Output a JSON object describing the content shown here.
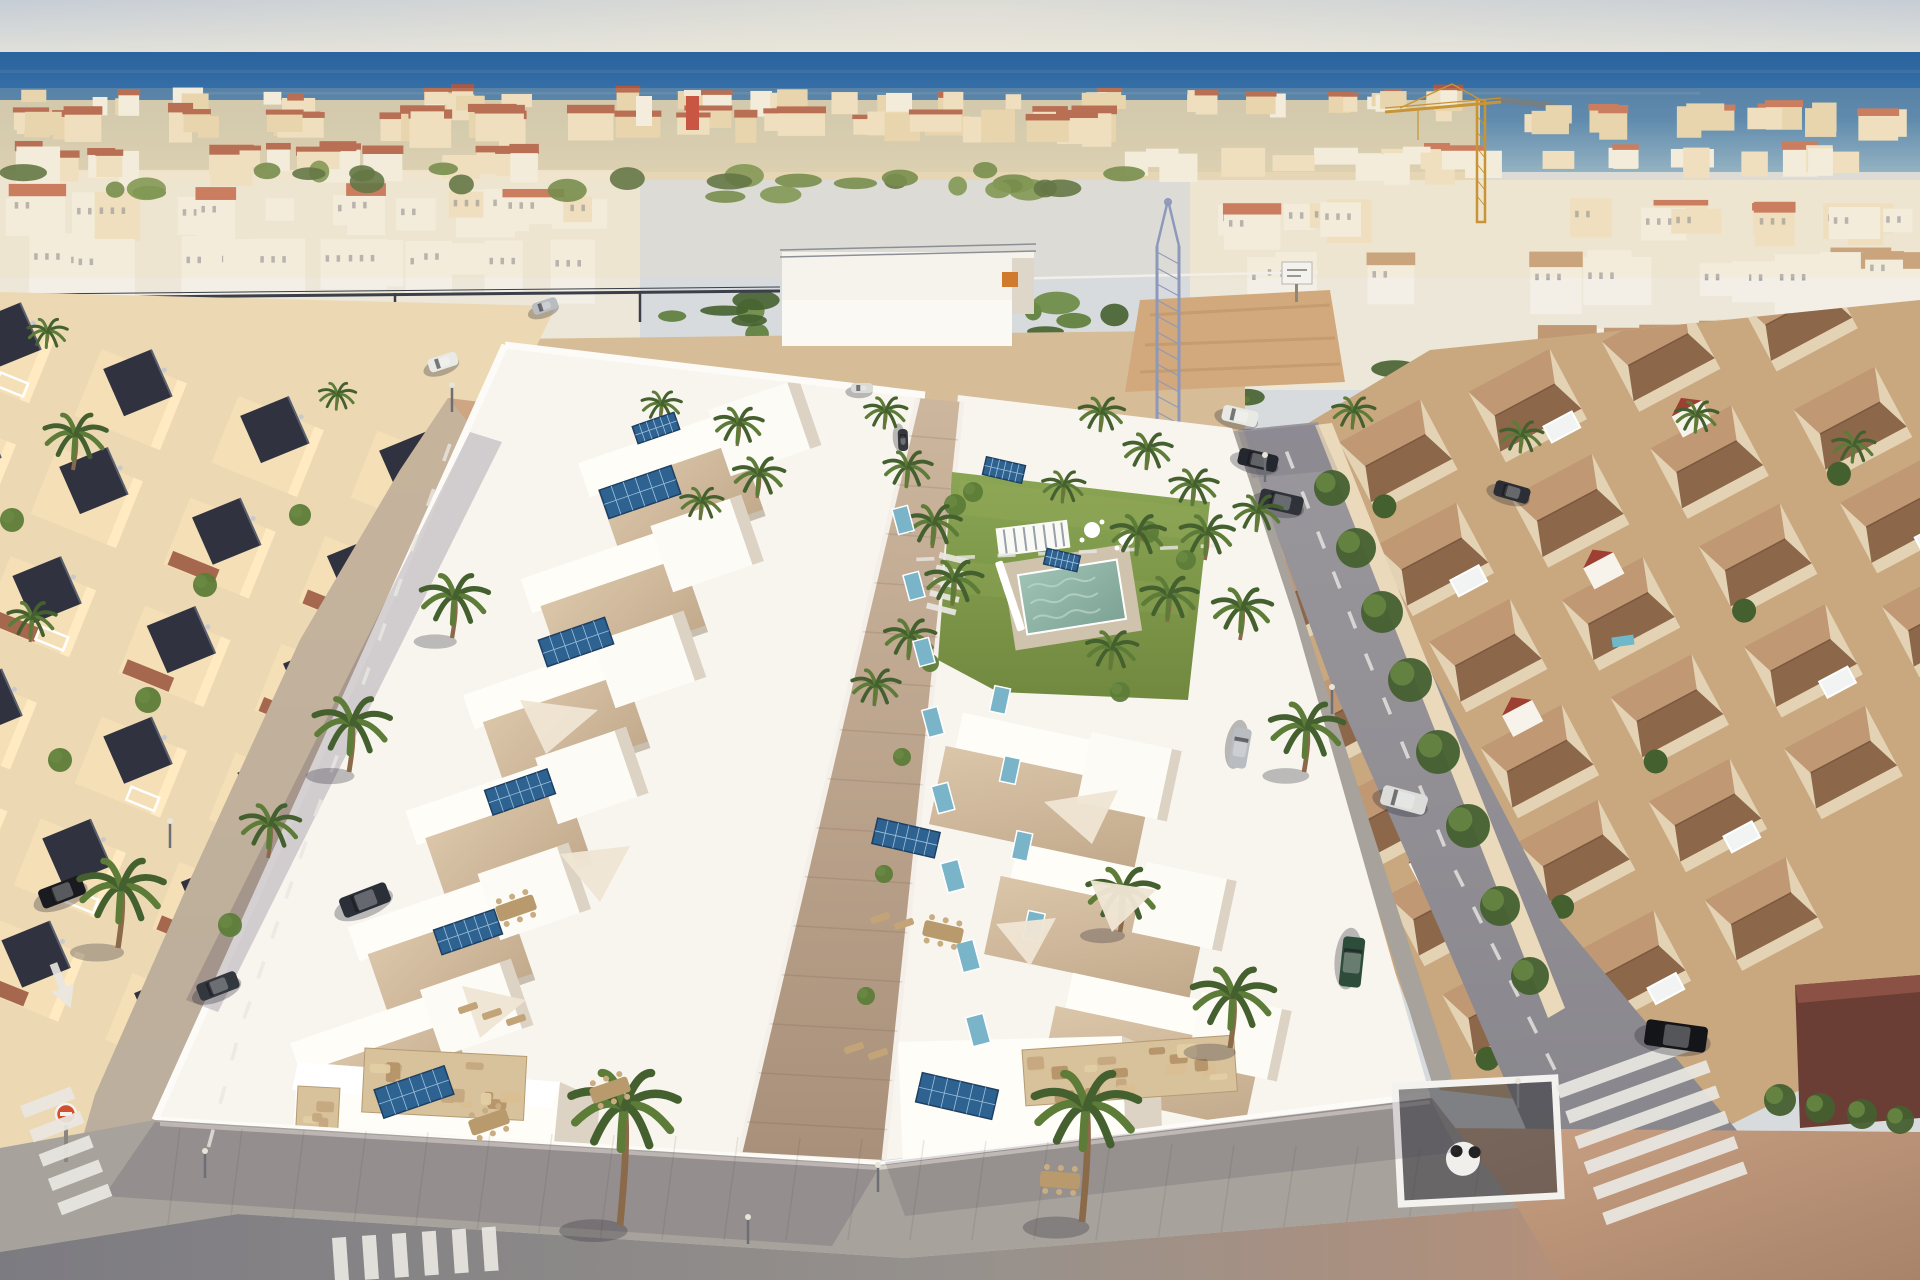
{
  "meta": {
    "description": "Aerial drone render of a new beachfront development of white villas with rooftop solar panels, communal lawn and pool, flanked by an older cream villa neighborhood on the left, terracotta-roofed townhouses on the right, palm-lined streets, zebra crossings, parked cars, construction cranes and the sea on the horizon."
  },
  "palette": {
    "sky_top": "#c6cdd5",
    "sky_low": "#e9e6dc",
    "sea_deep": "#2a639d",
    "sea_mid": "#3f78ae",
    "sea_near": "#7fa9c6",
    "city_white": "#f3efe6",
    "city_cream": "#e6d3ae",
    "city_cream2": "#eee0c2",
    "red_roof": "#ad5741",
    "red_roof2": "#c26a4f",
    "red_tower": "#c0392b",
    "green1": "#45602f",
    "green2": "#5d7c38",
    "green3": "#6a8a43",
    "villa_white": "#f8f5ef",
    "villa_bright": "#fffdf8",
    "villa_shade": "#ddd3c4",
    "terr_hi": "#dbc6a9",
    "terr_lo": "#c2a98c",
    "terr_dark": "#a9917b",
    "solar": "#2e6391",
    "solar_dark": "#1d3f63",
    "solar_teal": "#79b4c9",
    "lawn_hi": "#8aa554",
    "lawn_lo": "#71893f",
    "pool_hi": "#9fc3b4",
    "pool_lo": "#7da395",
    "deck": "#cfc3ae",
    "walk_hi": "#cdb69e",
    "walk_lo": "#a8907a",
    "street_warm": "#cfa683",
    "street_gray": "#8e8b90",
    "street_dark": "#77757c",
    "sidewalk": "#a7a29b",
    "sidewalk_hi": "#bcb5ab",
    "curb": "#d8d2c8",
    "stripe": "#e9e7e2",
    "hood_left": "#ecd9b4",
    "old_wall": "#f4dfb6",
    "old_sun": "#ffeac2",
    "old_roof": "#30333f",
    "old_terrace": "#9c5a42",
    "hood_right": "#c9a87f",
    "casa_wall": "#e3d3b4",
    "casa_roof_hi": "#c09873",
    "casa_roof_lo": "#8d6749",
    "casa_gable": "#f7f3ea",
    "casa_red": "#9e3f33",
    "stone_base": "#d8c29b",
    "sand": "#d6bd97",
    "dirt": "#d2a97c",
    "crane_yellow": "#c89435",
    "crane_blue": "#8d98ba",
    "sail": "#efe5d3",
    "furn": "#c2a478",
    "white": "#ffffff",
    "sign_red": "#d0512e",
    "shadow": "rgba(71,61,88,0.22)",
    "haze": "rgba(244,219,173,0.18)"
  },
  "scene": {
    "regions": {
      "sky": "hazy sky",
      "sea": "sea horizon",
      "distant_city": "coastal town",
      "left_hood": "older cream villas",
      "right_hood": "terracotta townhouses",
      "development": "new white villa blocks",
      "garden": "communal lawn and pool",
      "promenade": "paved sidewalk with palms"
    },
    "skyline_rows": [
      {
        "y": 92,
        "h": 22,
        "x0": 0,
        "x1": 1500,
        "n": 54,
        "cols": [
          "city_white",
          "city_cream",
          "city_cream2"
        ],
        "roofFrac": 0.25,
        "roof": "red_roof",
        "seed": 11,
        "wmin": 14,
        "wmax": 34
      },
      {
        "y": 112,
        "h": 30,
        "x0": 0,
        "x1": 1120,
        "n": 40,
        "cols": [
          "city_cream",
          "city_cream2"
        ],
        "roofFrac": 0.7,
        "roof": "red_roof",
        "seed": 22,
        "wmin": 20,
        "wmax": 52
      },
      {
        "y": 150,
        "h": 34,
        "x0": 0,
        "x1": 560,
        "n": 20,
        "cols": [
          "city_cream2",
          "city_white"
        ],
        "roofFrac": 0.45,
        "roof": "red_roof",
        "seed": 17,
        "wmin": 18,
        "wmax": 44
      },
      {
        "y": 108,
        "h": 26,
        "x0": 1480,
        "x1": 1920,
        "n": 16,
        "cols": [
          "city_cream",
          "city_cream2"
        ],
        "roofFrac": 0.5,
        "roof": "red_roof2",
        "seed": 33,
        "wmin": 18,
        "wmax": 40
      },
      {
        "y": 150,
        "h": 26,
        "x0": 1120,
        "x1": 1920,
        "n": 26,
        "cols": [
          "city_white",
          "city_cream2"
        ],
        "roofFrac": 0.3,
        "roof": "red_roof2",
        "seed": 44,
        "wmin": 20,
        "wmax": 44
      },
      {
        "y": 196,
        "h": 40,
        "x0": 0,
        "x1": 640,
        "n": 17,
        "cols": [
          "city_white",
          "city_white",
          "city_cream2"
        ],
        "roofFrac": 0.1,
        "roof": "red_roof2",
        "seed": 55,
        "wmin": 26,
        "wmax": 60,
        "win": 1
      },
      {
        "y": 243,
        "h": 52,
        "x0": 0,
        "x1": 630,
        "n": 13,
        "cols": [
          "city_white"
        ],
        "roofFrac": 0,
        "roof": "red_roof2",
        "seed": 66,
        "wmin": 30,
        "wmax": 70,
        "win": 1
      },
      {
        "y": 205,
        "h": 38,
        "x0": 1190,
        "x1": 1920,
        "n": 18,
        "cols": [
          "city_white",
          "city_cream2"
        ],
        "roofFrac": 0.15,
        "roof": "red_roof2",
        "seed": 77,
        "wmin": 26,
        "wmax": 58,
        "win": 1
      },
      {
        "y": 260,
        "h": 52,
        "x0": 1230,
        "x1": 1920,
        "n": 14,
        "cols": [
          "city_white"
        ],
        "roofFrac": 0.12,
        "roof": "casa_roof_hi",
        "seed": 88,
        "wmin": 34,
        "wmax": 72,
        "win": 1
      },
      {
        "y": 330,
        "h": 56,
        "x0": 1420,
        "x1": 1920,
        "n": 9,
        "cols": [
          "city_white",
          "city_cream"
        ],
        "roofFrac": 0.5,
        "roof": "casa_roof_hi",
        "seed": 99,
        "wmin": 40,
        "wmax": 84
      }
    ],
    "greens": [
      {
        "y": 168,
        "h": 30,
        "x0": 0,
        "x1": 1140,
        "n": 30,
        "seed": 5
      },
      {
        "y": 300,
        "h": 36,
        "x0": 620,
        "x1": 1190,
        "n": 14,
        "seed": 6
      },
      {
        "y": 362,
        "h": 40,
        "x0": 1190,
        "x1": 1920,
        "n": 16,
        "seed": 7
      },
      {
        "y": 430,
        "h": 36,
        "x0": 620,
        "x1": 900,
        "n": 8,
        "seed": 8
      }
    ],
    "bushes": [
      [
        1332,
        488,
        18
      ],
      [
        1356,
        548,
        20
      ],
      [
        1382,
        612,
        21
      ],
      [
        1410,
        680,
        22
      ],
      [
        1438,
        752,
        22
      ],
      [
        1468,
        826,
        22
      ],
      [
        1500,
        906,
        20
      ],
      [
        1530,
        976,
        19
      ],
      [
        12,
        520,
        12
      ],
      [
        205,
        585,
        12
      ],
      [
        300,
        515,
        11
      ],
      [
        148,
        700,
        13
      ],
      [
        60,
        760,
        12
      ],
      [
        230,
        925,
        12
      ],
      [
        955,
        505,
        11
      ],
      [
        973,
        492,
        10
      ],
      [
        1148,
        532,
        11
      ],
      [
        1186,
        560,
        10
      ],
      [
        930,
        663,
        9
      ],
      [
        902,
        757,
        9
      ],
      [
        884,
        874,
        9
      ],
      [
        866,
        996,
        9
      ],
      [
        1120,
        692,
        10
      ],
      [
        1780,
        1100,
        16
      ],
      [
        1820,
        1108,
        15
      ],
      [
        1862,
        1114,
        15
      ],
      [
        1900,
        1120,
        14
      ]
    ],
    "palms": [
      [
        73,
        470,
        2.2,
        16
      ],
      [
        30,
        642,
        1.7,
        14
      ],
      [
        452,
        638,
        2.4,
        17
      ],
      [
        349,
        772,
        2.7,
        18
      ],
      [
        118,
        948,
        3.0,
        20
      ],
      [
        268,
        858,
        2.1,
        16
      ],
      [
        46,
        346,
        1.4,
        10
      ],
      [
        336,
        408,
        1.3,
        10
      ],
      [
        737,
        446,
        1.7,
        13
      ],
      [
        757,
        498,
        1.8,
        13
      ],
      [
        700,
        520,
        1.5,
        12
      ],
      [
        660,
        420,
        1.4,
        11
      ],
      [
        884,
        428,
        1.5,
        11
      ],
      [
        906,
        488,
        1.7,
        12
      ],
      [
        932,
        548,
        1.9,
        13
      ],
      [
        952,
        606,
        2.0,
        13
      ],
      [
        908,
        660,
        1.8,
        13
      ],
      [
        874,
        706,
        1.7,
        12
      ],
      [
        1136,
        556,
        1.9,
        12
      ],
      [
        1167,
        622,
        2.0,
        13
      ],
      [
        1110,
        670,
        1.8,
        12
      ],
      [
        1205,
        560,
        1.9,
        14
      ],
      [
        1240,
        640,
        2.1,
        15
      ],
      [
        1304,
        772,
        2.6,
        17
      ],
      [
        1120,
        932,
        2.5,
        16
      ],
      [
        1230,
        1048,
        2.9,
        18
      ],
      [
        620,
        1225,
        3.8,
        31
      ],
      [
        1082,
        1222,
        3.7,
        31
      ],
      [
        1352,
        428,
        1.5,
        11
      ],
      [
        1520,
        452,
        1.5,
        11
      ],
      [
        1695,
        432,
        1.5,
        11
      ],
      [
        1852,
        462,
        1.5,
        11
      ],
      [
        1100,
        432,
        1.6,
        12
      ],
      [
        1146,
        470,
        1.7,
        12
      ],
      [
        1192,
        506,
        1.7,
        12
      ],
      [
        1256,
        532,
        1.7,
        12
      ],
      [
        1062,
        502,
        1.5,
        11
      ]
    ],
    "cars": [
      {
        "x": 443,
        "y": 362,
        "r": -18,
        "l": 30,
        "w": 14,
        "fill": "#e9e9e6",
        "name": "car-white-top-left"
      },
      {
        "x": 545,
        "y": 306,
        "r": -18,
        "l": 26,
        "w": 12,
        "fill": "#b9bcc1",
        "name": "car-gray-top-left"
      },
      {
        "x": 365,
        "y": 900,
        "r": -21,
        "l": 50,
        "w": 21,
        "fill": "#2b2f38",
        "name": "pickup-dark-left-street"
      },
      {
        "x": 62,
        "y": 892,
        "r": -21,
        "l": 46,
        "w": 20,
        "fill": "#191b20",
        "name": "car-black-left-street"
      },
      {
        "x": 218,
        "y": 986,
        "r": -21,
        "l": 42,
        "w": 18,
        "fill": "#33373e",
        "name": "car-dark-left-street"
      },
      {
        "x": 1240,
        "y": 416,
        "r": 13,
        "l": 36,
        "w": 16,
        "fill": "#e8e8e4",
        "name": "pickup-white-right-street"
      },
      {
        "x": 1258,
        "y": 460,
        "r": 13,
        "l": 40,
        "w": 17,
        "fill": "#24272d",
        "name": "car-dark-right-street"
      },
      {
        "x": 1281,
        "y": 502,
        "r": 13,
        "l": 44,
        "w": 19,
        "fill": "#2f3239",
        "name": "suv-dark-right-street"
      },
      {
        "x": 1404,
        "y": 800,
        "r": 15,
        "l": 46,
        "w": 20,
        "fill": "#dcddda",
        "name": "car-white-right-street"
      },
      {
        "x": 1676,
        "y": 1036,
        "r": 8,
        "l": 62,
        "w": 26,
        "fill": "#141519",
        "name": "car-black-bottom-right"
      },
      {
        "x": 1352,
        "y": 962,
        "r": 96,
        "l": 50,
        "w": 22,
        "fill": "#2e4c3a",
        "name": "suv-green-right-block"
      },
      {
        "x": 1240,
        "y": 748,
        "r": 100,
        "l": 40,
        "w": 18,
        "fill": "#b9bcc0",
        "name": "car-silver-right-block"
      },
      {
        "x": 862,
        "y": 388,
        "r": 0,
        "l": 22,
        "w": 10,
        "fill": "#dadad7",
        "name": "car-distant-1"
      },
      {
        "x": 903,
        "y": 440,
        "r": 88,
        "l": 22,
        "w": 10,
        "fill": "#35383e",
        "name": "car-distant-2"
      },
      {
        "x": 1512,
        "y": 492,
        "r": 16,
        "l": 36,
        "w": 16,
        "fill": "#2b2e34",
        "name": "car-dark-far-right"
      }
    ],
    "solar_panels": [
      [
        640,
        492,
        76,
        30,
        -19,
        0
      ],
      [
        576,
        642,
        70,
        28,
        -19,
        0
      ],
      [
        520,
        792,
        66,
        26,
        -19,
        0
      ],
      [
        468,
        932,
        64,
        26,
        -19,
        0
      ],
      [
        414,
        1092,
        74,
        30,
        -19,
        0
      ],
      [
        656,
        428,
        44,
        18,
        -19,
        0
      ],
      [
        906,
        838,
        64,
        26,
        13,
        0
      ],
      [
        957,
        1096,
        78,
        30,
        13,
        0
      ],
      [
        1004,
        470,
        40,
        18,
        13,
        0
      ],
      [
        1062,
        560,
        34,
        16,
        13,
        0
      ],
      [
        903,
        520,
        16,
        26,
        -15,
        1
      ],
      [
        914,
        586,
        16,
        26,
        -15,
        1
      ],
      [
        924,
        652,
        16,
        26,
        -15,
        1
      ],
      [
        933,
        722,
        16,
        28,
        -15,
        1
      ],
      [
        943,
        798,
        17,
        28,
        -15,
        1
      ],
      [
        953,
        876,
        18,
        30,
        -15,
        1
      ],
      [
        968,
        956,
        18,
        30,
        -15,
        1
      ],
      [
        978,
        1030,
        18,
        30,
        -15,
        1
      ],
      [
        1000,
        700,
        16,
        26,
        12,
        1
      ],
      [
        1010,
        770,
        16,
        26,
        12,
        1
      ],
      [
        1022,
        846,
        16,
        28,
        12,
        1
      ],
      [
        1034,
        926,
        17,
        28,
        12,
        1
      ]
    ],
    "sails": [
      {
        "x": 520,
        "y": 700,
        "pts": "0,0 78,10 26,54"
      },
      {
        "x": 560,
        "y": 846,
        "pts": "0,8 70,0 40,56"
      },
      {
        "x": 462,
        "y": 986,
        "pts": "0,0 64,14 18,52"
      },
      {
        "x": 1044,
        "y": 790,
        "pts": "0,12 74,0 48,54"
      },
      {
        "x": 1090,
        "y": 880,
        "pts": "0,0 66,10 22,52"
      },
      {
        "x": 996,
        "y": 918,
        "pts": "0,6 60,0 34,48"
      }
    ],
    "loungers_pool": [
      [
        1002,
        572
      ],
      [
        1006,
        584
      ],
      [
        1010,
        596
      ],
      [
        1014,
        608
      ],
      [
        1018,
        620
      ]
    ],
    "loungers_terrace": [
      [
        468,
        1008
      ],
      [
        492,
        1014
      ],
      [
        516,
        1020
      ],
      [
        880,
        918
      ],
      [
        904,
        924
      ],
      [
        854,
        1048
      ],
      [
        878,
        1054
      ]
    ],
    "tables": [
      [
        516,
        908,
        -19
      ],
      [
        943,
        932,
        13
      ],
      [
        489,
        1122,
        -19
      ],
      [
        610,
        1090,
        -19
      ],
      [
        1060,
        1180,
        4
      ]
    ],
    "crosswalks": [
      {
        "x": 20,
        "y": 1106,
        "r": -21,
        "n": 5,
        "sw": 13,
        "gap": 13,
        "len": 54,
        "dir": "y",
        "name": "crosswalk-left-street"
      },
      {
        "x": 332,
        "y": 1238,
        "r": -4,
        "n": 6,
        "sw": 14,
        "gap": 16,
        "len": 44,
        "dir": "x",
        "name": "crosswalk-bottom-street"
      },
      {
        "x": 1556,
        "y": 1086,
        "r": -20,
        "n": 6,
        "sw": 13,
        "gap": 14,
        "len": 150,
        "dir": "y",
        "name": "crosswalk-right-street"
      },
      {
        "x": 940,
        "y": 552,
        "r": 14,
        "n": 5,
        "sw": 6,
        "gap": 7,
        "len": 30,
        "dir": "y",
        "name": "crosswalk-top-road"
      }
    ],
    "dash_lines": [
      {
        "pts": [
          [
            455,
            430
          ],
          [
            390,
            610
          ],
          [
            310,
            830
          ],
          [
            240,
            1030
          ],
          [
            205,
            1160
          ]
        ]
      },
      {
        "pts": [
          [
            1282,
            440
          ],
          [
            1360,
            640
          ],
          [
            1450,
            860
          ],
          [
            1560,
            1080
          ]
        ]
      },
      {
        "pts": [
          [
            905,
            560
          ],
          [
            1230,
            545
          ]
        ]
      }
    ],
    "lamps": [
      [
        170,
        848
      ],
      [
        452,
        412
      ],
      [
        878,
        1192
      ],
      [
        1265,
        482
      ],
      [
        1332,
        714
      ],
      [
        1518,
        1108
      ],
      [
        748,
        1244
      ],
      [
        205,
        1178
      ]
    ],
    "casa_rows": [
      {
        "sx": 1262,
        "sy": 500,
        "n": 6,
        "seed": 1
      },
      {
        "sx": 1392,
        "sy": 452,
        "n": 6,
        "seed": 2
      },
      {
        "sx": 1524,
        "sy": 404,
        "n": 6,
        "seed": 3
      },
      {
        "sx": 1660,
        "sy": 356,
        "n": 5,
        "seed": 4
      },
      {
        "sx": 1800,
        "sy": 318,
        "n": 4,
        "seed": 5
      }
    ],
    "old_rows": [
      {
        "sx": 398,
        "sy": 486,
        "n": 6,
        "seed": 1
      },
      {
        "sx": 262,
        "sy": 440,
        "n": 6,
        "seed": 2
      },
      {
        "sx": 128,
        "sy": 396,
        "n": 5,
        "seed": 3
      },
      {
        "sx": 0,
        "sy": 352,
        "n": 4,
        "seed": 4
      }
    ]
  }
}
